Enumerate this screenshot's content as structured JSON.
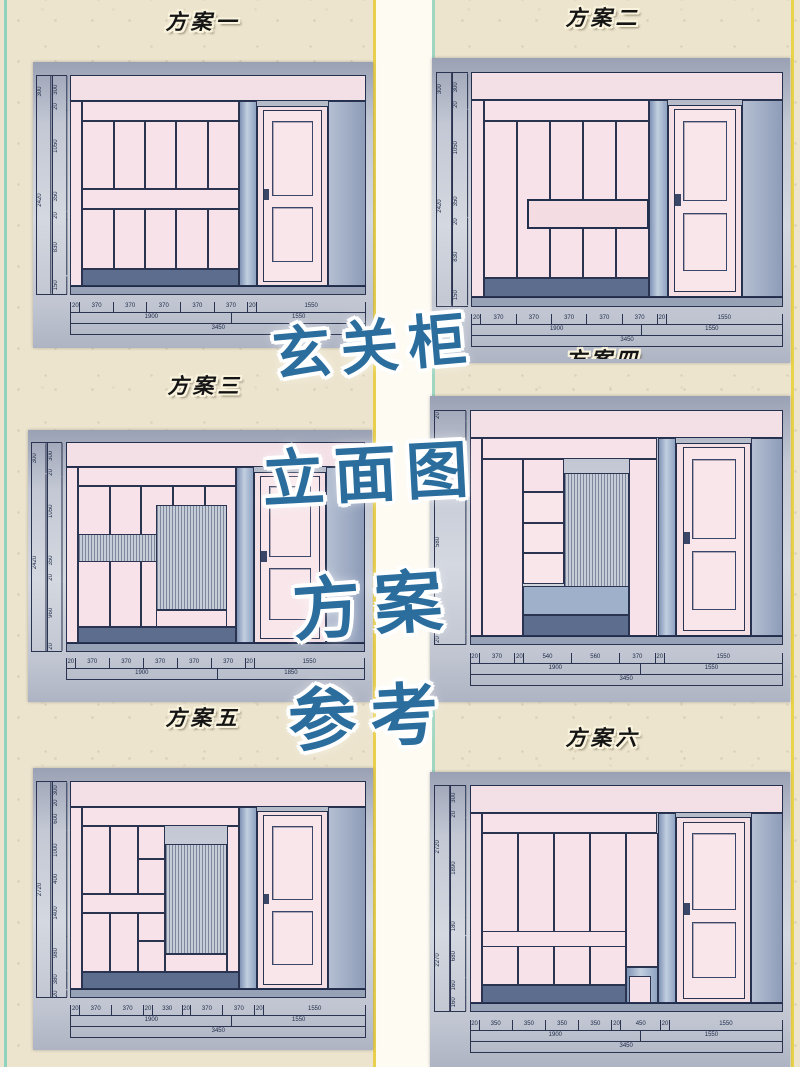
{
  "poster": {
    "overlay_lines": [
      "玄关柜",
      "立面图",
      "方案",
      "参考"
    ],
    "colors": {
      "accent_blue": "#2b6e9e",
      "paper": "#ece4cd",
      "cabinet_pink": "#f6e2e8",
      "drawing_gray_blue": "#8fa3c2",
      "ink": "#2a3350",
      "edge_teal": "#8fd2bd",
      "edge_yellow": "#e9d34b"
    }
  },
  "panels": [
    {
      "title": "方案一",
      "dims_left_outer": [
        "300",
        "2420"
      ],
      "dims_left": [
        "300",
        "20",
        "1050",
        "350",
        "20",
        "830",
        "150"
      ],
      "dims_bottom_row1": [
        "20",
        "370",
        "370",
        "370",
        "370",
        "370",
        "20",
        "1550"
      ],
      "dims_bottom_row2": [
        "1900",
        "1550"
      ],
      "dims_bottom_row3": [
        "3450"
      ]
    },
    {
      "title": "方案二",
      "dims_left_outer": [
        "300",
        "2420"
      ],
      "dims_left": [
        "300",
        "20",
        "1050",
        "350",
        "20",
        "830",
        "150"
      ],
      "dims_bottom_row1": [
        "20",
        "370",
        "370",
        "370",
        "370",
        "370",
        "20",
        "1550"
      ],
      "dims_bottom_row2": [
        "1900",
        "1550"
      ],
      "dims_bottom_row3": [
        "3450"
      ]
    },
    {
      "title": "方案三",
      "dims_left_outer": [
        "300",
        "2420"
      ],
      "dims_left": [
        "300",
        "20",
        "1050",
        "350",
        "20",
        "960",
        "20"
      ],
      "dims_bottom_row1": [
        "20",
        "370",
        "370",
        "370",
        "370",
        "370",
        "20",
        "1550"
      ],
      "dims_bottom_row2": [
        "1900",
        "1850"
      ],
      "dims_bottom_row3": []
    },
    {
      "title": "方案四",
      "dims_left_outer": [],
      "dims_left": [
        "20",
        "380",
        "580",
        "200",
        "20"
      ],
      "dims_bottom_row1": [
        "20",
        "370",
        "20",
        "540",
        "560",
        "370",
        "20",
        "1550"
      ],
      "dims_bottom_row2": [
        "1900",
        "1550"
      ],
      "dims_bottom_row3": [
        "3450"
      ]
    },
    {
      "title": "方案五",
      "dims_left_outer": [
        "2720"
      ],
      "dims_left": [
        "300",
        "20",
        "600",
        "1000",
        "400",
        "1400",
        "980",
        "380",
        "20"
      ],
      "dims_bottom_row1": [
        "20",
        "370",
        "370",
        "20",
        "330",
        "20",
        "370",
        "370",
        "20",
        "1550"
      ],
      "dims_bottom_row2": [
        "1900",
        "1550"
      ],
      "dims_bottom_row3": [
        "3450"
      ]
    },
    {
      "title": "方案六",
      "dims_left_outer": [
        "2720",
        "2270"
      ],
      "dims_left": [
        "300",
        "20",
        "1890",
        "180",
        "680",
        "160",
        "160"
      ],
      "dims_bottom_row1": [
        "20",
        "350",
        "350",
        "350",
        "350",
        "20",
        "450",
        "20",
        "1550"
      ],
      "dims_bottom_row2": [
        "1900",
        "1550"
      ],
      "dims_bottom_row3": [
        "3450"
      ]
    }
  ]
}
